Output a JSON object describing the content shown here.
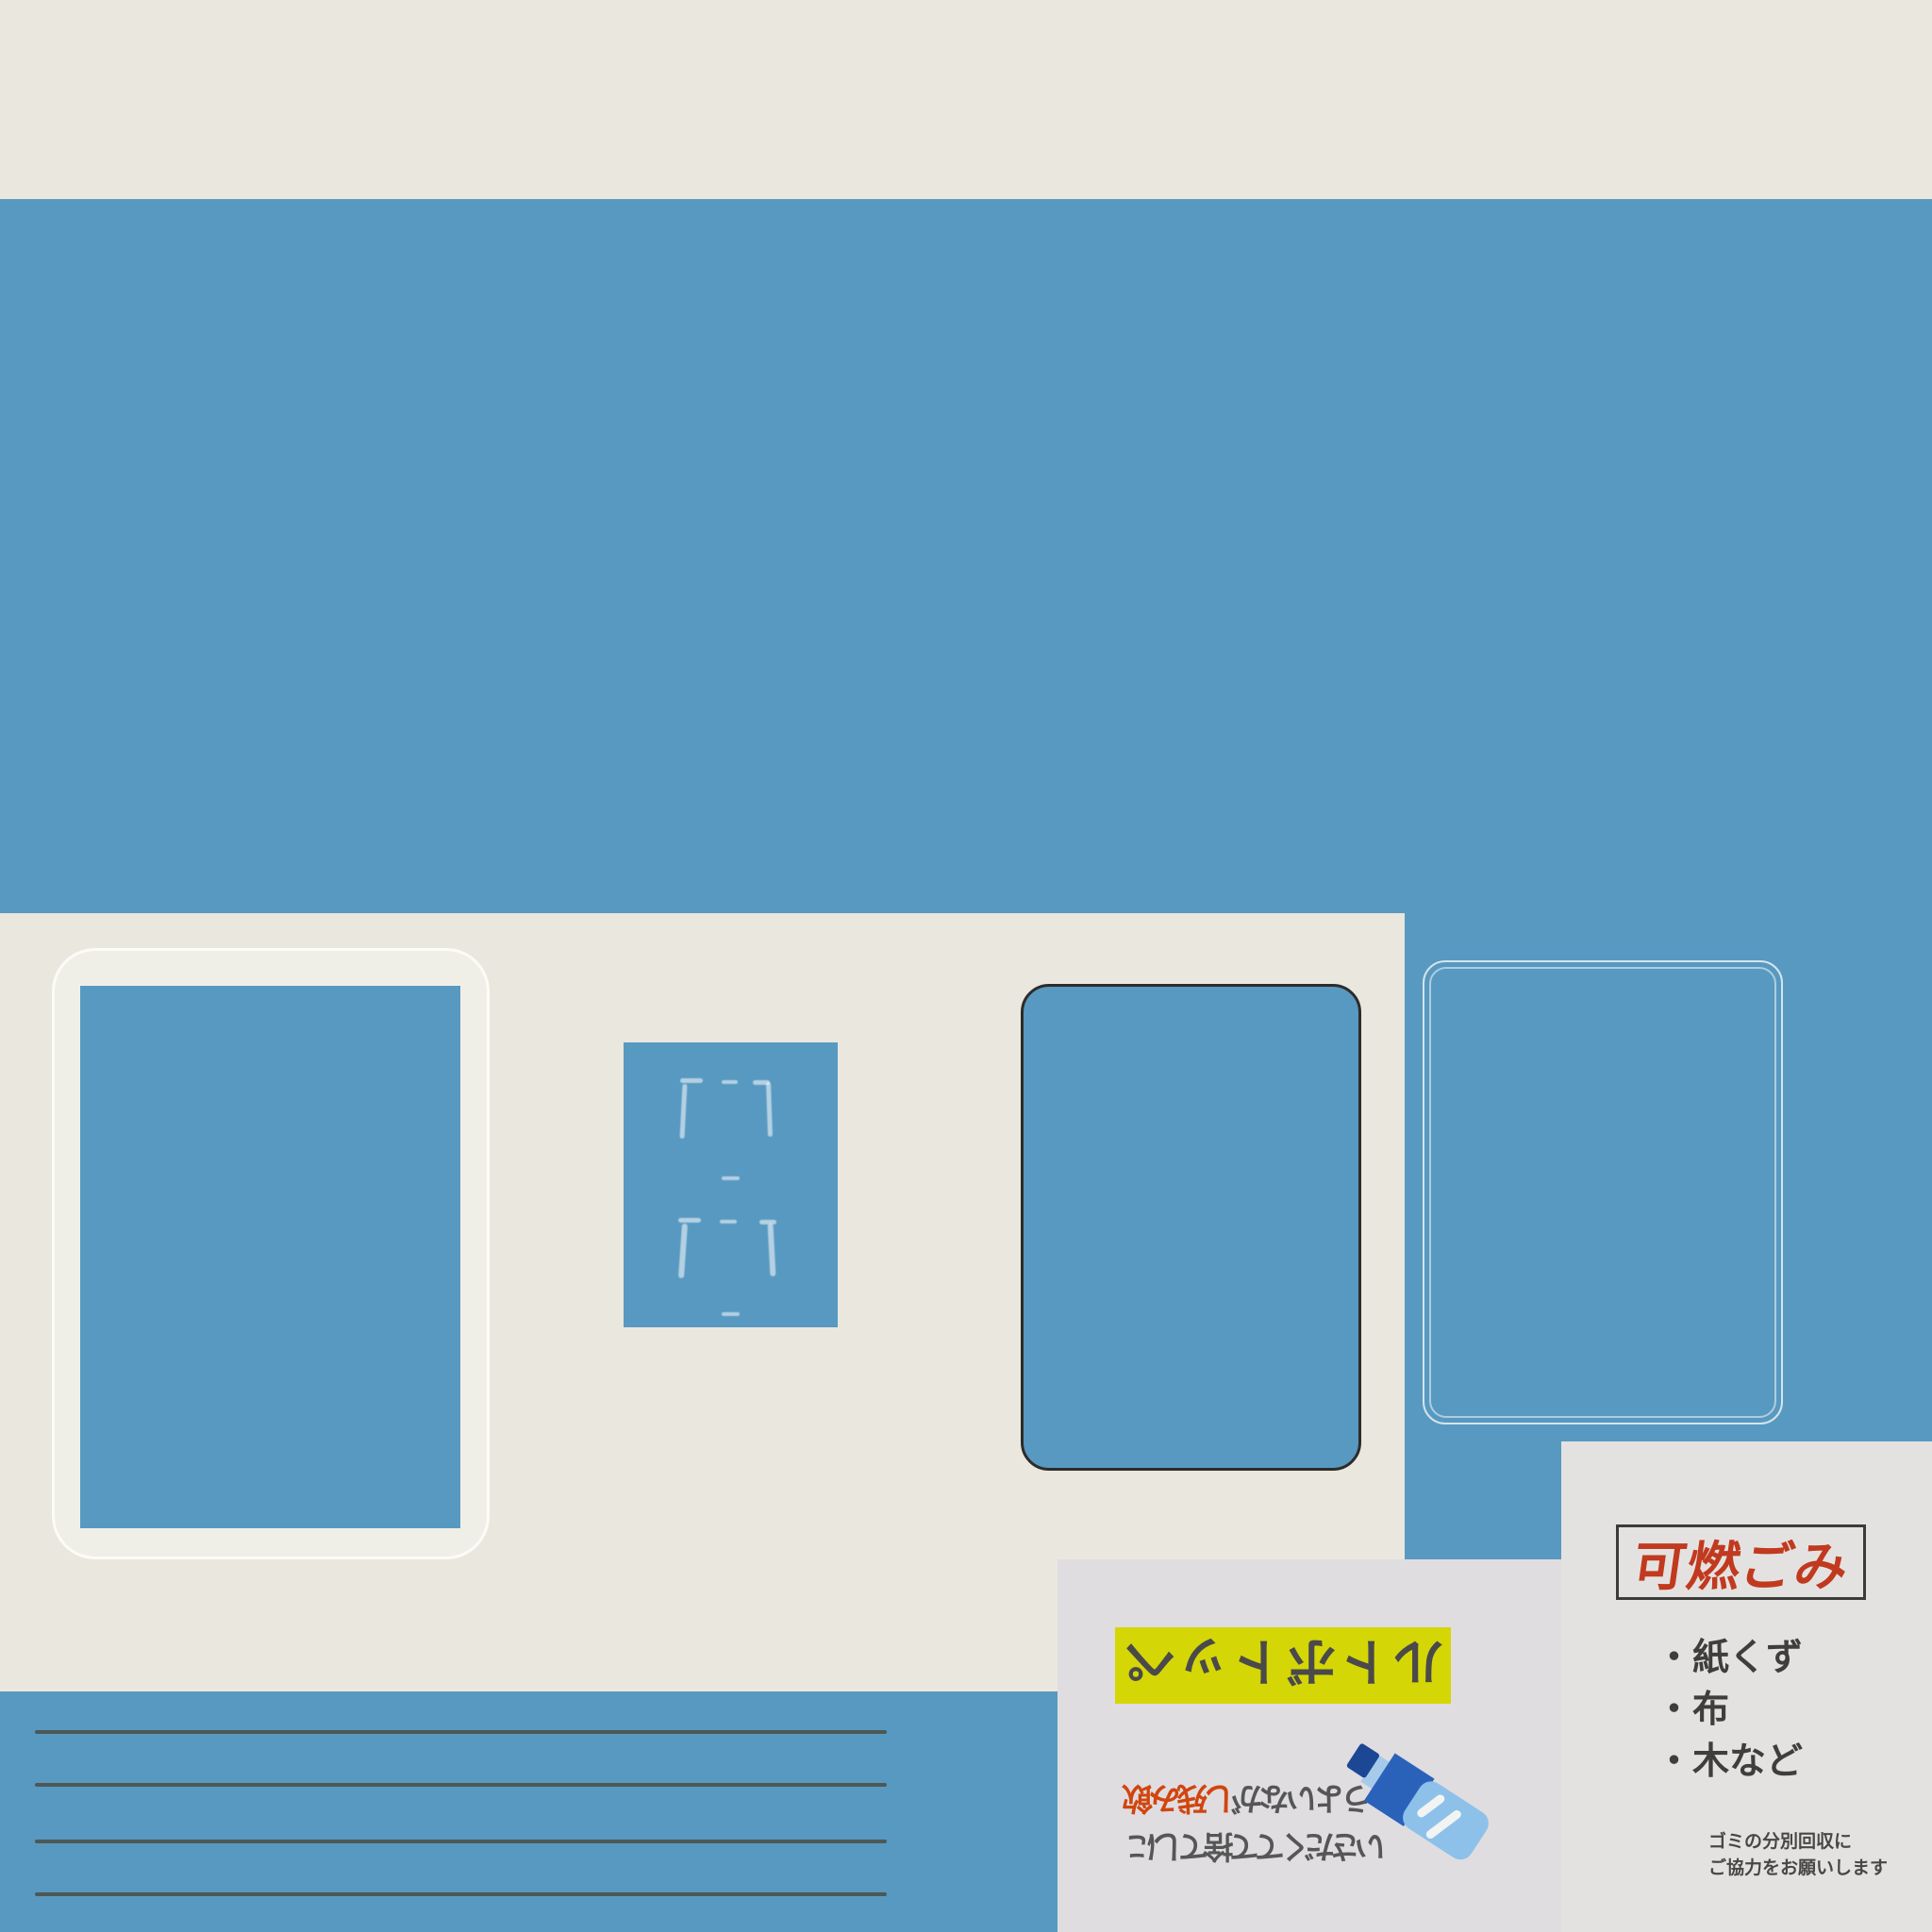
{
  "colors": {
    "wall_blue": "#5899c1",
    "wall_cream": "#eae7de",
    "shutter_line_dark": "#4b4f46",
    "dark_frame": "#2c2c2a",
    "chalk_white": "#f4f7f6",
    "pet_paper_gray": "#dfdde0",
    "burnable_paper_gray": "#e4e2e1",
    "highlight_yellow": "#d5d606",
    "burnable_title_red": "#c13a1f",
    "emphasis_red": "#d1450e",
    "notice_text_gray": "#4a4a4a",
    "bottle_cap_navy": "#1b4795",
    "bottle_label_blue": "#2b62b9",
    "bottle_body_blue": "#8dc1e9"
  },
  "pet_bottle_notice": {
    "orientation": "upside-down",
    "title": "ペットボトル",
    "instruction_emphasis": "飲み残し",
    "instruction_line1_rest": "がないよう",
    "instruction_line2": "にして捨ててください",
    "icon": "pet-bottle-icon"
  },
  "burnable_garbage_notice": {
    "title": "可燃ごみ",
    "items": [
      "・紙くず",
      "・布",
      "・木など"
    ],
    "footer_line1": "ゴミの分別回収に",
    "footer_line2": "ご協力をお願いします"
  }
}
